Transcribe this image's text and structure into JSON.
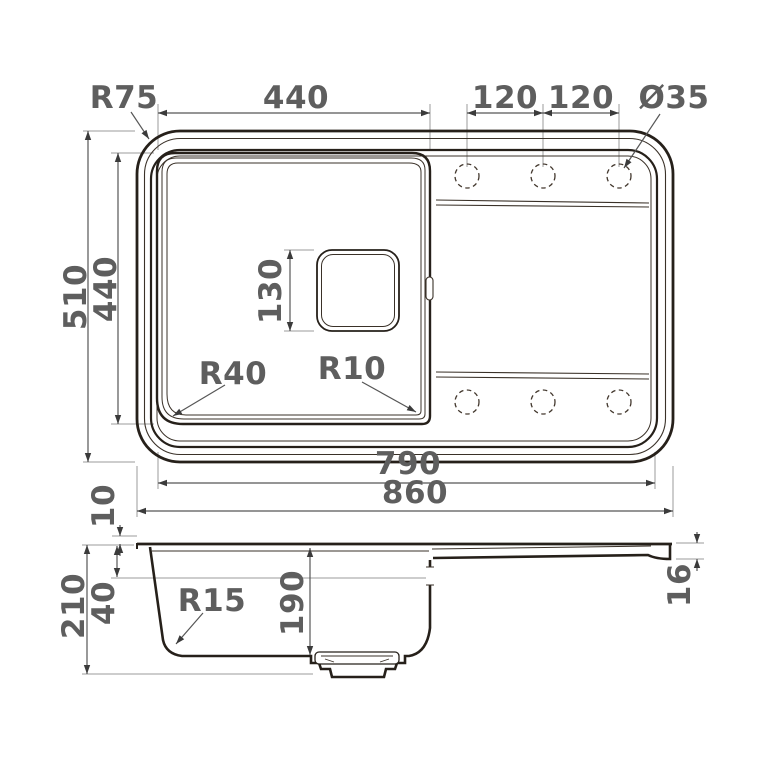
{
  "drawing_type": "kitchen sink technical drawing with top view and section view",
  "colors": {
    "line": "#26201a",
    "dimension_line": "#565656",
    "extension_line": "#9b9b9b",
    "label_text": "#5e5e5e",
    "background": "#ffffff"
  },
  "top_view": {
    "dims": {
      "corner_radius": "R75",
      "bowl_width": "440",
      "hole_spacing_left": "120",
      "hole_spacing_right": "120",
      "hole_diameter": "Ø35",
      "overall_depth": "510",
      "bowl_depth": "440",
      "drain_size": "130",
      "bowl_radius_bottom_left": "R40",
      "bowl_radius_bottom_right": "R10",
      "inner_width": "790",
      "overall_width": "860"
    }
  },
  "side_view": {
    "dims": {
      "rim_height": "10",
      "overall_height": "210",
      "ledge_depth": "40",
      "bottom_radius": "R15",
      "bowl_inner_depth": "190",
      "drainer_edge_thickness": "16"
    }
  }
}
